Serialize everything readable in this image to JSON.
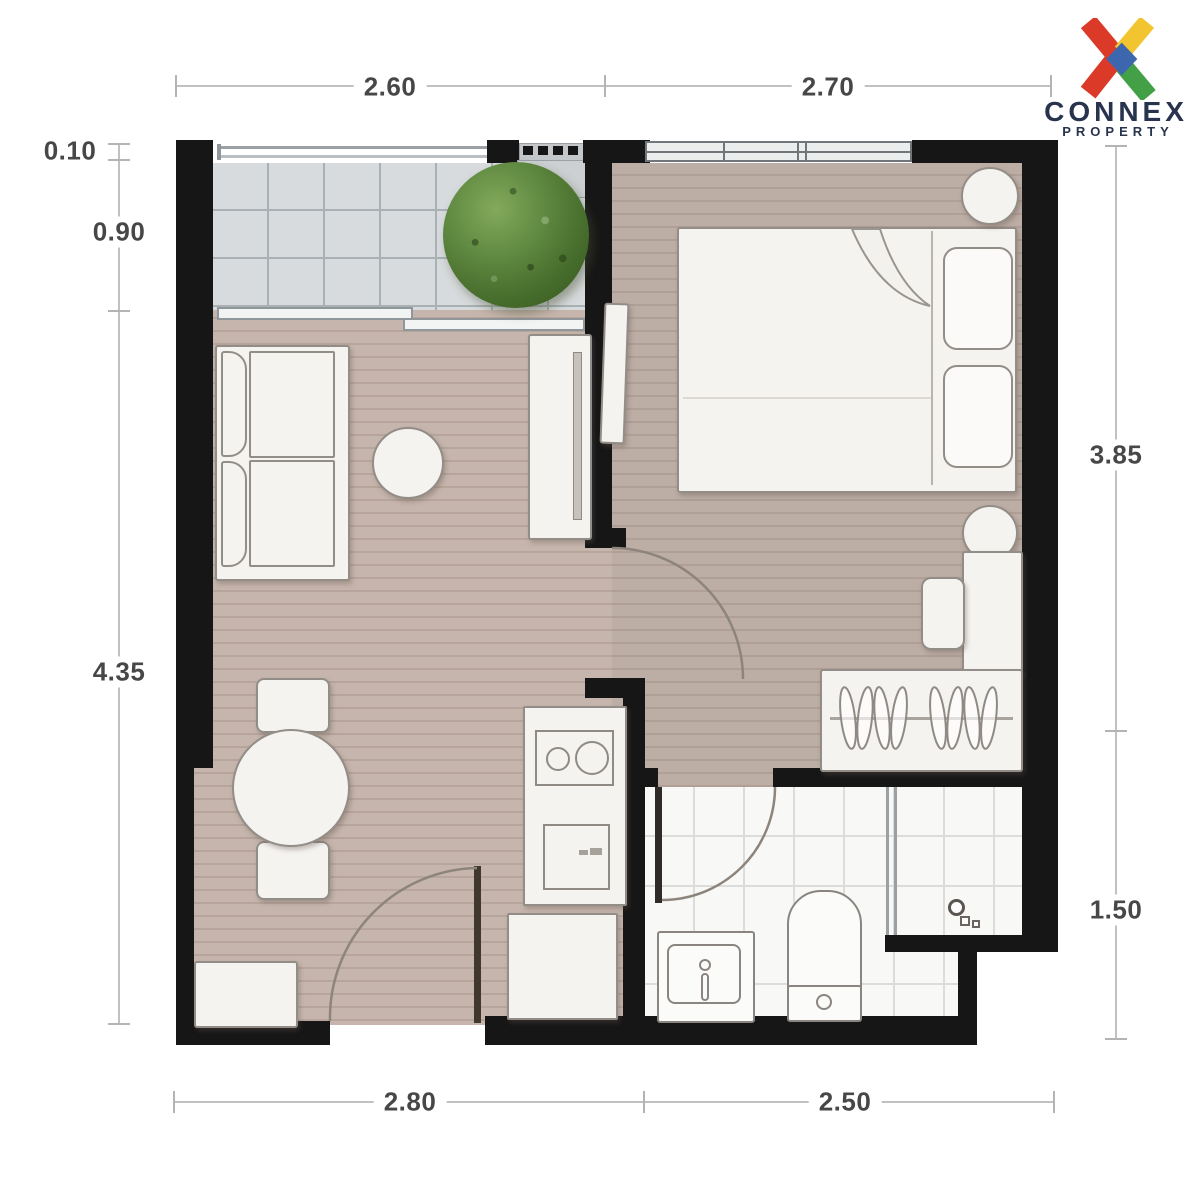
{
  "logo": {
    "name": "CONNEX",
    "subtitle": "PROPERTY"
  },
  "dims": {
    "top1": "2.60",
    "top2": "2.70",
    "left1": "0.10",
    "left2": "0.90",
    "left3": "4.35",
    "right1": "3.85",
    "right2": "1.50",
    "bottom1": "2.80",
    "bottom2": "2.50"
  },
  "colors": {
    "wall": "#161616",
    "floor_wood": "#c6b5ac",
    "balcony_tile": "#d7dbdd",
    "bath_tile": "#f8f8f6",
    "furniture": "#f5f3f0",
    "logo_red": "#DC3A28",
    "logo_yellow": "#F2C430",
    "logo_green": "#43A047",
    "logo_blue": "#3C67AE",
    "logo_text": "#28334E",
    "dim_text": "#474747"
  }
}
